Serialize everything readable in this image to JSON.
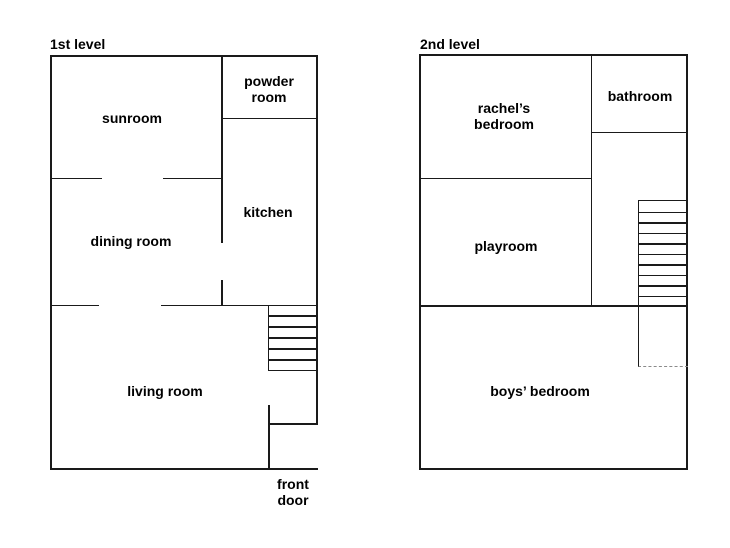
{
  "colors": {
    "background": "#ffffff",
    "wall": "#1a1a1a",
    "text": "#000000",
    "stairwell_dash": "#8a8a8a"
  },
  "floors": [
    {
      "title": "1st level",
      "stairs": {
        "treads": 6
      },
      "rooms": [
        {
          "name": "sunroom",
          "lines": [
            "sunroom"
          ]
        },
        {
          "name": "powder-room",
          "lines": [
            "powder",
            "room"
          ]
        },
        {
          "name": "kitchen",
          "lines": [
            "kitchen"
          ]
        },
        {
          "name": "dining-room",
          "lines": [
            "dining room"
          ]
        },
        {
          "name": "living-room",
          "lines": [
            "living room"
          ]
        },
        {
          "name": "front-door",
          "lines": [
            "front",
            "door"
          ]
        }
      ]
    },
    {
      "title": "2nd level",
      "stairs": {
        "treads": 10
      },
      "rooms": [
        {
          "name": "rachels-bedroom",
          "lines": [
            "rachel’s",
            "bedroom"
          ]
        },
        {
          "name": "bathroom",
          "lines": [
            "bathroom"
          ]
        },
        {
          "name": "playroom",
          "lines": [
            "playroom"
          ]
        },
        {
          "name": "boys-bedroom",
          "lines": [
            "boys’ bedroom"
          ]
        }
      ]
    }
  ]
}
